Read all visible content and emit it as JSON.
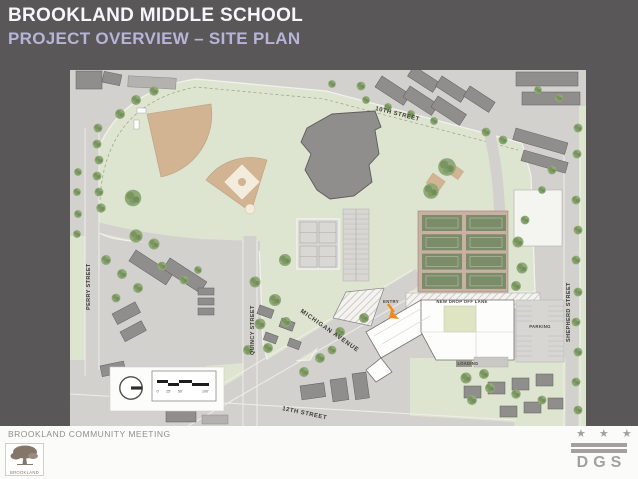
{
  "slide": {
    "title": "BROOKLAND MIDDLE SCHOOL",
    "subtitle": "PROJECT OVERVIEW – SITE PLAN",
    "background_color": "#5a5759",
    "subtitle_color": "#b6b4d8"
  },
  "footer": {
    "meeting_text": "BROOKLAND COMMUNITY MEETING",
    "brookland_logo_label": "BROOKLAND",
    "dgs_stars": "★ ★ ★",
    "dgs_logo_label": "DGS"
  },
  "map": {
    "street_labels": {
      "tenth": "10TH STREET",
      "perry": "PERRY STREET",
      "quincy": "QUINCY STREET",
      "michigan": "MICHIGAN AVENUE",
      "shepherd": "SHEPHERD STREET",
      "twelfth": "12TH STREET"
    },
    "site_labels": {
      "entry": "ENTRY",
      "drop_off": "NEW DROP OFF LANE",
      "parking": "PARKING",
      "loading": "LOADING"
    },
    "scale_bar": {
      "t0": "0'",
      "t25": "25'",
      "t50": "50'",
      "t100": "100'"
    },
    "colors": {
      "park_green": "#dde4cf",
      "street_gray": "#d2d1ce",
      "field_tan": "#d2b493",
      "tennis_surround": "#c8b0a2",
      "court_green": "#7a8c68",
      "building_gray": "#8f8e8c",
      "new_building_white": "#fdfdfb",
      "entry_arrow_orange": "#f08c1e"
    }
  }
}
